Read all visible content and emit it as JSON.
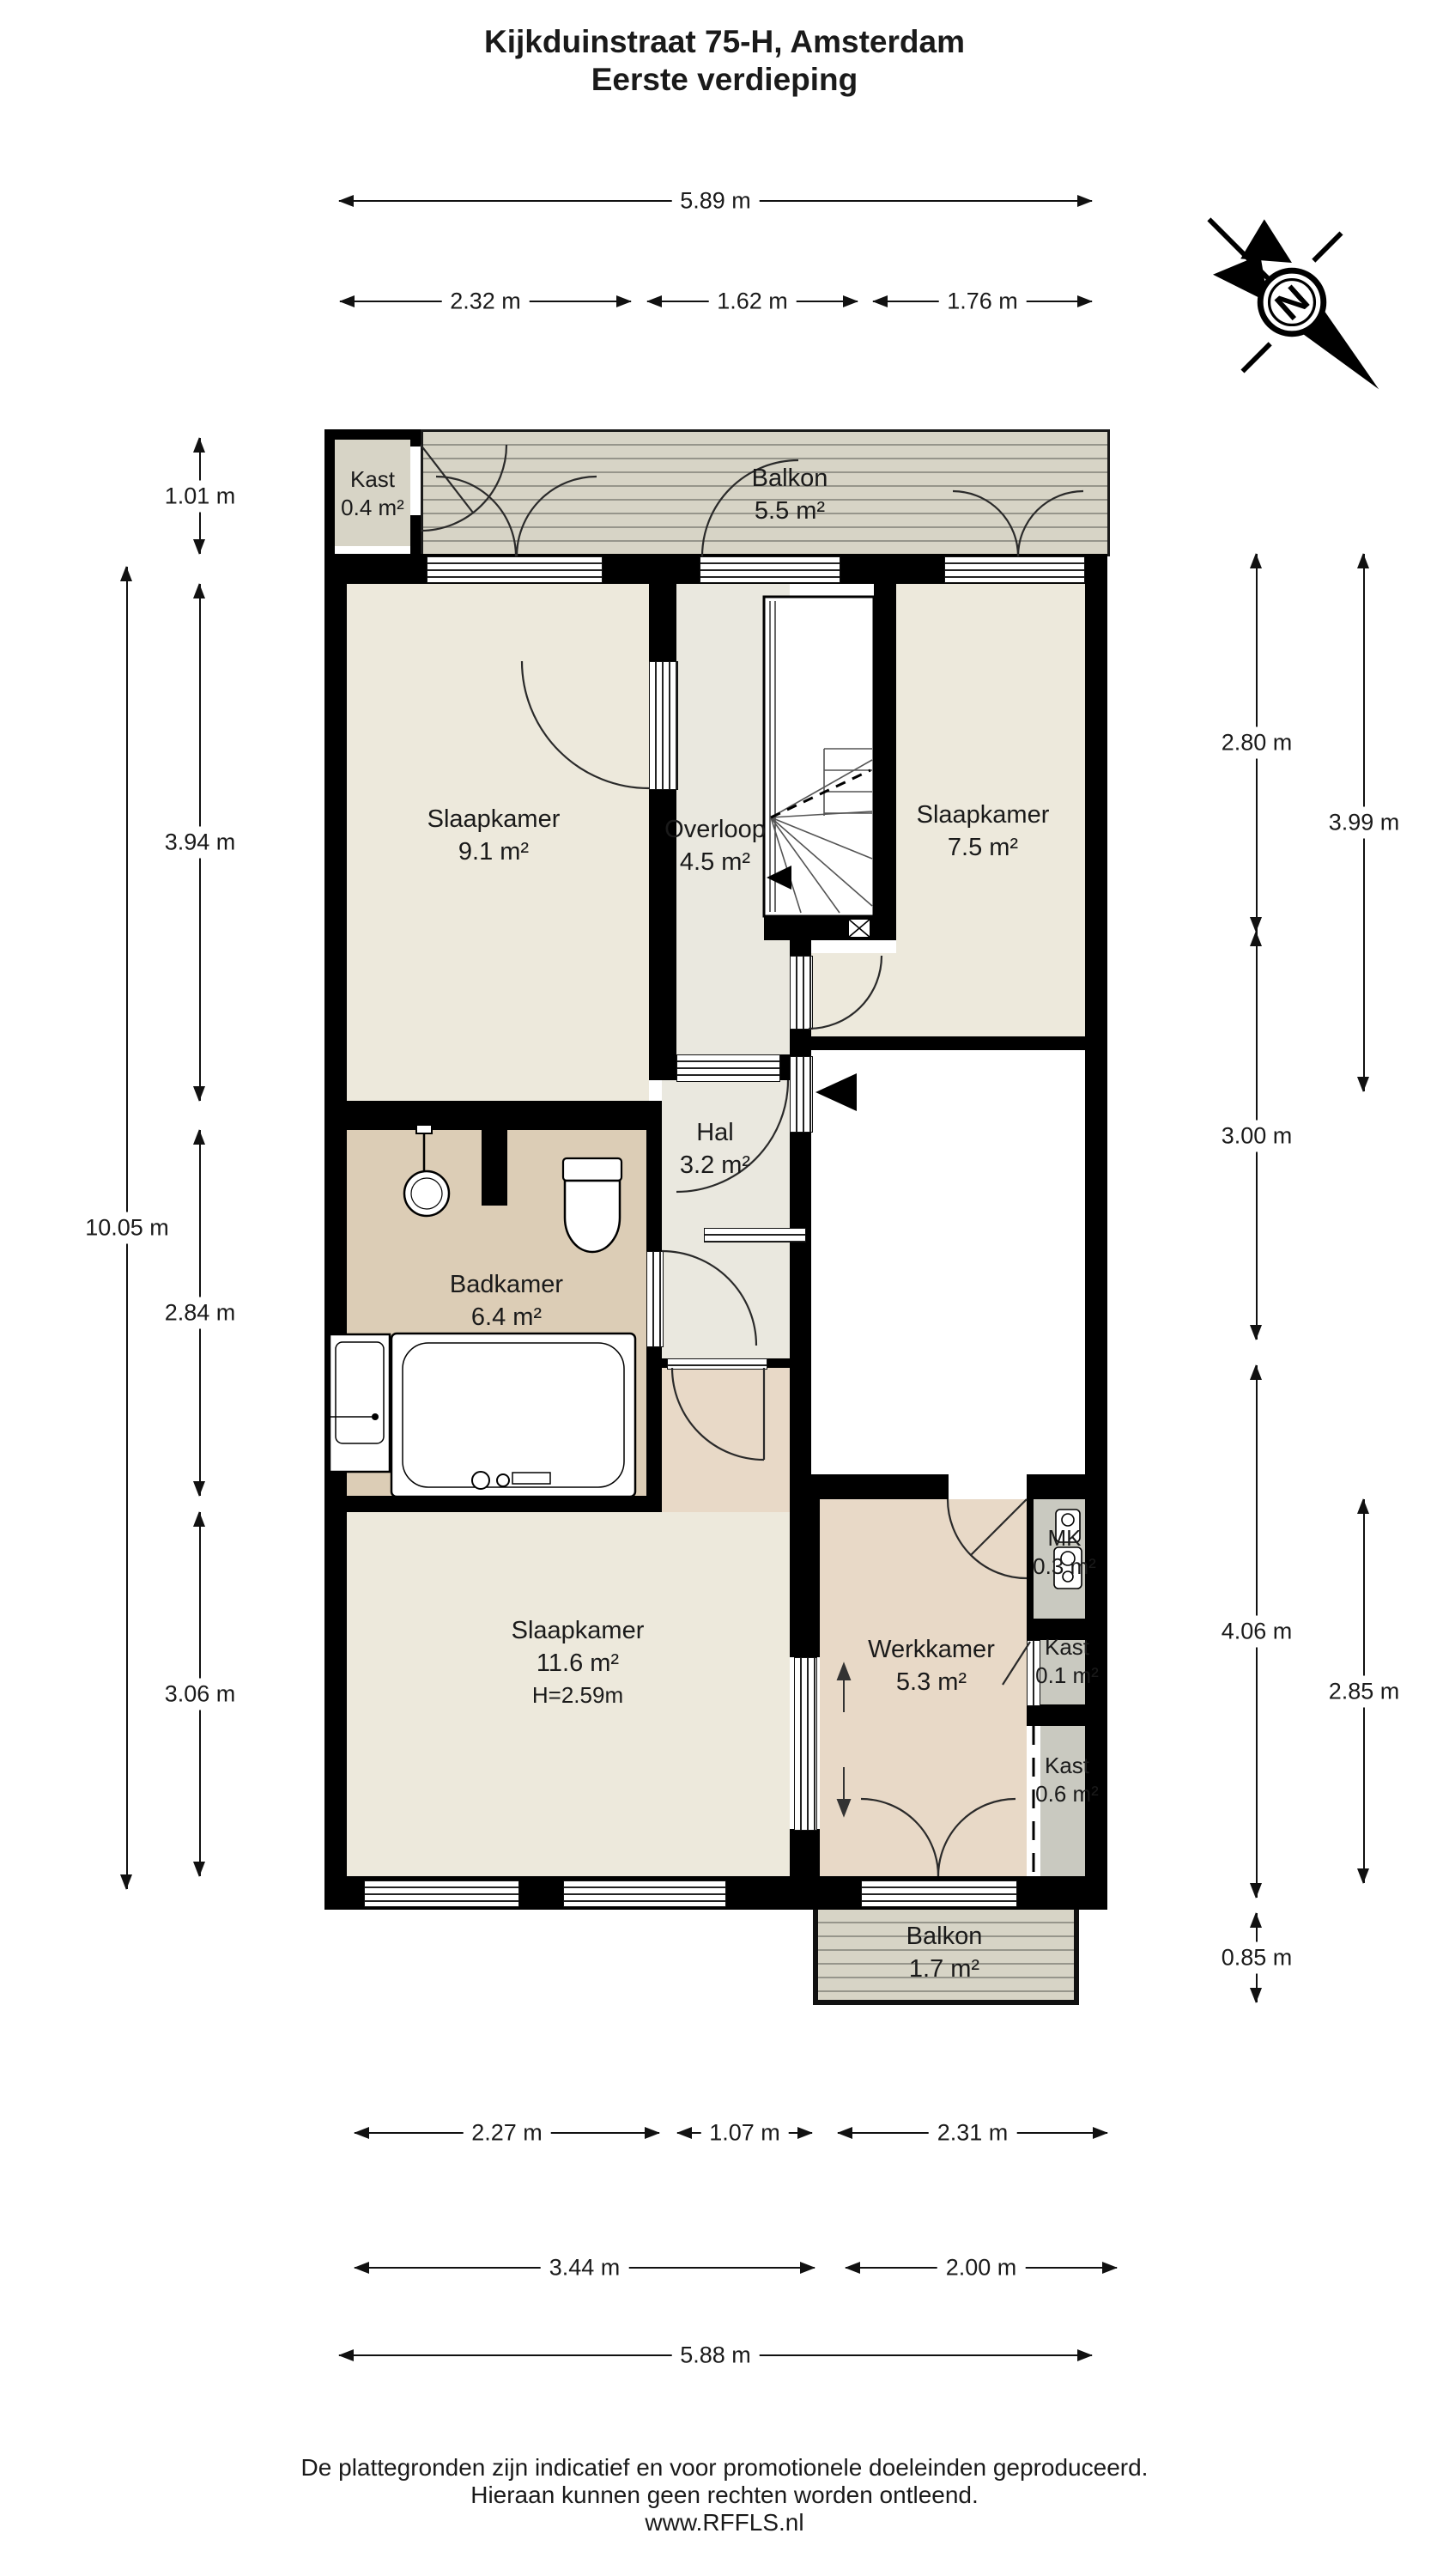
{
  "title": {
    "line1": "Kijkduinstraat 75-H, Amsterdam",
    "line2": "Eerste verdieping"
  },
  "compass": {
    "north_label": "N"
  },
  "rooms": {
    "kast_top": {
      "name": "Kast",
      "area": "0.4 m²"
    },
    "balkon_top": {
      "name": "Balkon",
      "area": "5.5 m²"
    },
    "slaapkamer_1": {
      "name": "Slaapkamer",
      "area": "9.1 m²"
    },
    "overloop": {
      "name": "Overloop",
      "area": "4.5 m²"
    },
    "slaapkamer_2": {
      "name": "Slaapkamer",
      "area": "7.5 m²"
    },
    "hal": {
      "name": "Hal",
      "area": "3.2 m²"
    },
    "badkamer": {
      "name": "Badkamer",
      "area": "6.4 m²"
    },
    "slaapkamer_3": {
      "name": "Slaapkamer",
      "area": "11.6 m²",
      "ceiling_height": "H=2.59m"
    },
    "werkkamer": {
      "name": "Werkkamer",
      "area": "5.3 m²"
    },
    "mk": {
      "name": "MK",
      "area": "0.3 m²"
    },
    "kast_small": {
      "name": "Kast",
      "area": "0.1 m²"
    },
    "kast_mid": {
      "name": "Kast",
      "area": "0.6 m²"
    },
    "balkon_bottom": {
      "name": "Balkon",
      "area": "1.7 m²"
    }
  },
  "dimensions": {
    "top_total": "5.89 m",
    "top_a": "2.32 m",
    "top_b": "1.62 m",
    "top_c": "1.76 m",
    "left_total": "10.05 m",
    "left_a": "1.01 m",
    "left_b": "3.94 m",
    "left_c": "2.84 m",
    "left_d": "3.06 m",
    "right_a": "2.80 m",
    "right_b": "3.00 m",
    "right_c": "4.06 m",
    "right_d": "0.85 m",
    "right_outer_a": "3.99 m",
    "right_outer_b": "2.85 m",
    "bottom_a": "2.27 m",
    "bottom_b": "1.07 m",
    "bottom_c": "2.31 m",
    "bottom_d": "3.44 m",
    "bottom_e": "2.00 m",
    "bottom_total": "5.88 m"
  },
  "footer": {
    "line1": "De plattegronden zijn indicatief en voor promotionele doeleinden geproduceerd.",
    "line2": "Hieraan kunnen geen rechten worden ontleend.",
    "line3": "www.RFFLS.nl"
  },
  "colors": {
    "wall": "#000000",
    "room_cream": "#ede9dc",
    "room_light": "#eae8df",
    "room_tan": "#dccdb6",
    "room_pink": "#e8d9c7",
    "deck_gray": "#d7d4c6",
    "closet_gray": "#c9c9c0"
  }
}
